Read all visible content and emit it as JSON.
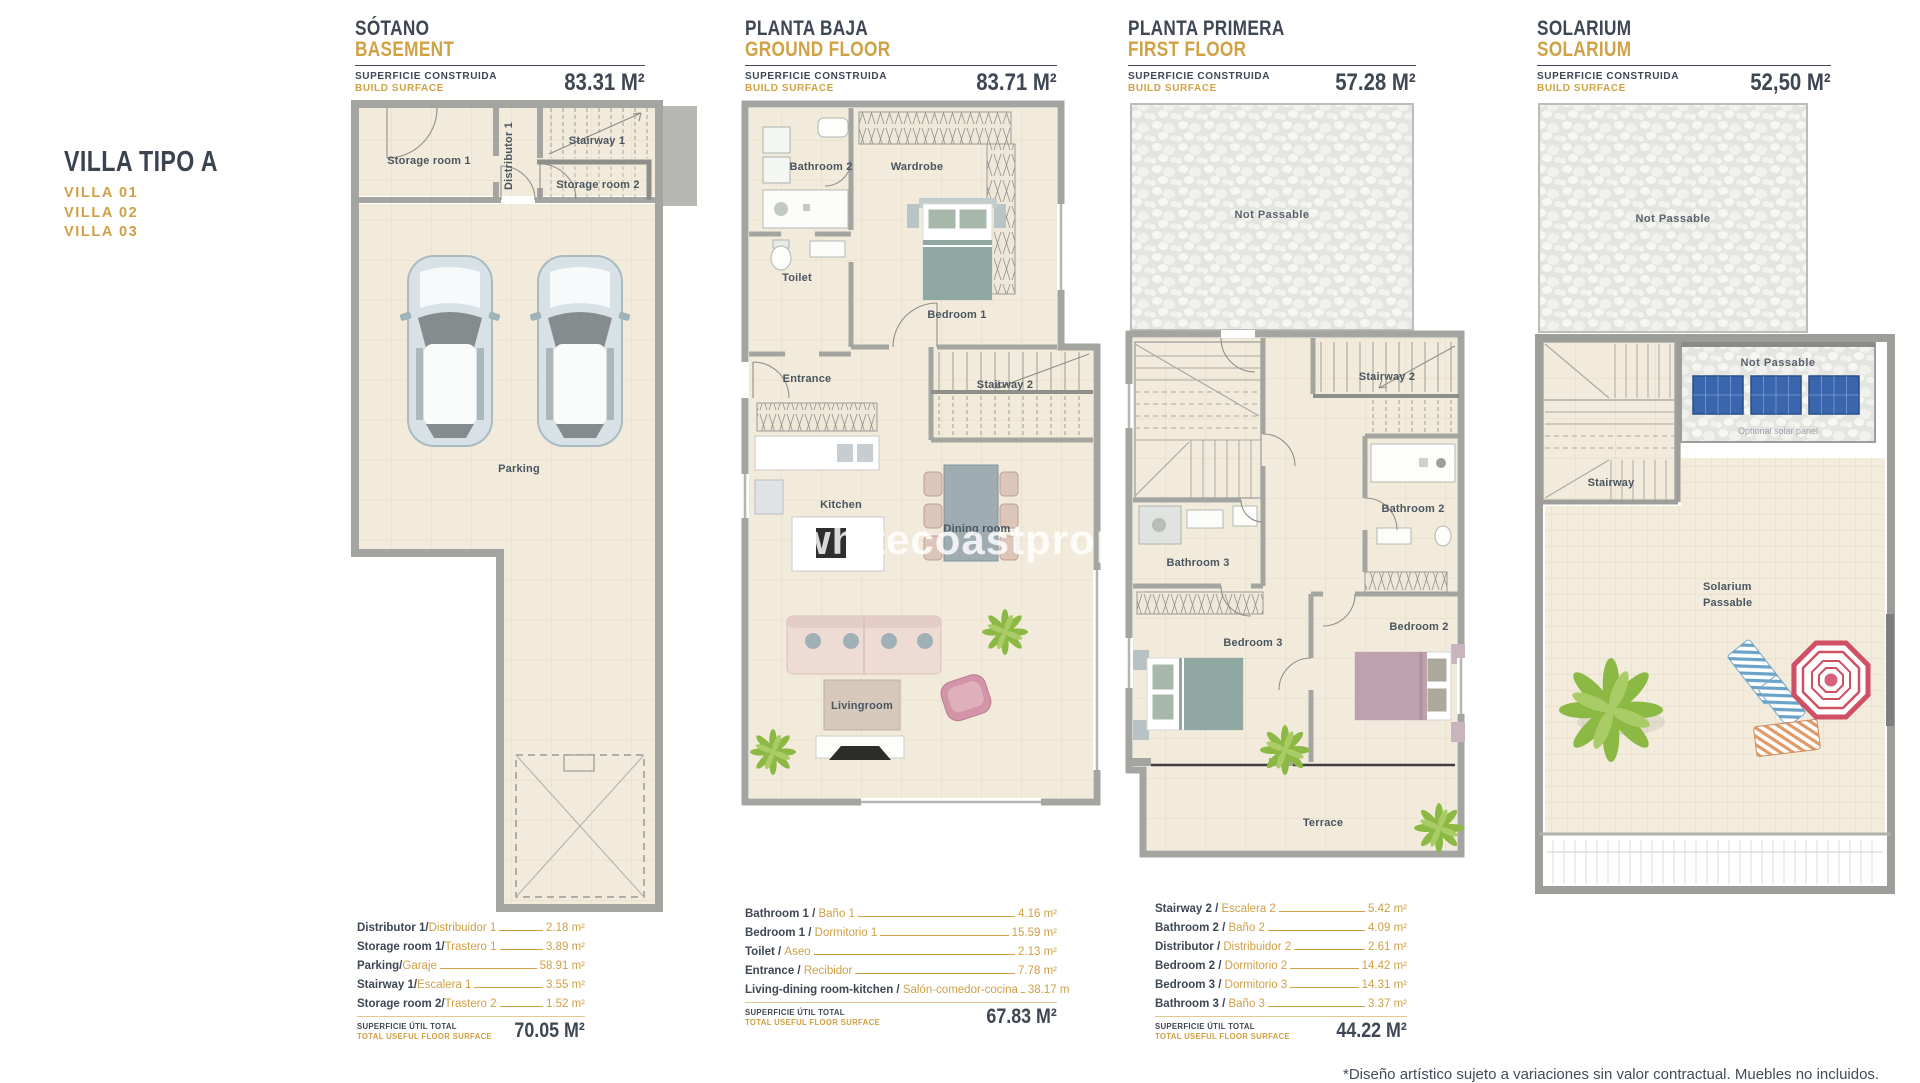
{
  "sidebar": {
    "title": "VILLA TIPO A",
    "villas": [
      "VILLA 01",
      "VILLA 02",
      "VILLA 03"
    ]
  },
  "labels": {
    "surface_es": "SUPERFICIE CONSTRUIDA",
    "surface_en": "BUILD SURFACE",
    "total_es": "SUPERFICIE ÚTIL TOTAL",
    "total_en": "TOTAL USEFUL FLOOR SURFACE"
  },
  "watermark": "whitecoastproperties",
  "disclaimer": "*Diseño artístico sujeto a variaciones sin valor contractual. Muebles no incluidos.",
  "colors": {
    "accent": "#cfa045",
    "ink": "#3e4753",
    "wall": "#a4a4a1",
    "floor": "#f2ebdb",
    "bed_teal": "#8fa9a2",
    "bed_mauve": "#bfa1ad",
    "solar_panel": "#3a66ad",
    "umbrella": "#cf4f63",
    "plant": "#8cb944"
  },
  "plans": [
    {
      "id": "basement",
      "title_es": "SÓTANO",
      "title_en": "BASEMENT",
      "area": "83.31 M²",
      "rooms": {
        "storage1": "Storage room 1",
        "distributor": "Distributor 1",
        "stairway1": "Stairway 1",
        "storage2": "Storage room 2",
        "parking": "Parking"
      },
      "legend": [
        {
          "en": "Distributor 1/",
          "es": "Distribuidor 1",
          "value": "2.18 m²"
        },
        {
          "en": "Storage room 1/",
          "es": "Trastero 1",
          "value": "3.89 m²"
        },
        {
          "en": "Parking/",
          "es": "Garaje",
          "value": "58.91 m²"
        },
        {
          "en": "Stairway 1/",
          "es": "Escalera 1",
          "value": "3.55 m²"
        },
        {
          "en": "Storage room 2/",
          "es": "Trastero 2",
          "value": "1.52 m²"
        }
      ],
      "total": "70.05 M²"
    },
    {
      "id": "ground-floor",
      "title_es": "PLANTA BAJA",
      "title_en": "GROUND FLOOR",
      "area": "83.71 M²",
      "rooms": {
        "bathroom2": "Bathroom 2",
        "wardrobe": "Wardrobe",
        "toilet": "Toilet",
        "bedroom1": "Bedroom 1",
        "entrance": "Entrance",
        "stairway2": "Stairway 2",
        "kitchen": "Kitchen",
        "dining": "Dining room",
        "living": "Livingroom"
      },
      "legend": [
        {
          "en": "Bathroom 1 / ",
          "es": "Baño 1",
          "value": "4.16 m²"
        },
        {
          "en": "Bedroom 1 / ",
          "es": "Dormitorio 1",
          "value": "15.59 m²"
        },
        {
          "en": "Toilet / ",
          "es": "Aseo",
          "value": "2.13 m²"
        },
        {
          "en": "Entrance / ",
          "es": "Recibidor",
          "value": "7.78 m²"
        },
        {
          "en": "Living-dining room-kitchen / ",
          "es": "Salón-comedor-cocina",
          "value": "38.17 m"
        }
      ],
      "total": "67.83 M²"
    },
    {
      "id": "first-floor",
      "title_es": "PLANTA PRIMERA",
      "title_en": "FIRST FLOOR",
      "area": "57.28 M²",
      "rooms": {
        "not_passable": "Not Passable",
        "stairway2": "Stairway 2",
        "bathroom2": "Bathroom 2",
        "bathroom3": "Bathroom 3",
        "bedroom3": "Bedroom 3",
        "bedroom2": "Bedroom 2",
        "terrace": "Terrace"
      },
      "legend": [
        {
          "en": "Stairway 2 / ",
          "es": "Escalera 2",
          "value": "5.42 m²"
        },
        {
          "en": "Bathroom 2 / ",
          "es": "Baño 2",
          "value": "4.09 m²"
        },
        {
          "en": "Distributor / ",
          "es": "Distribuidor 2",
          "value": "2.61 m²"
        },
        {
          "en": "Bedroom 2 / ",
          "es": "Dormitorio 2",
          "value": "14.42 m²"
        },
        {
          "en": "Bedroom 3 / ",
          "es": "Dormitorio 3",
          "value": "14.31 m²"
        },
        {
          "en": "Bathroom 3 / ",
          "es": "Baño 3",
          "value": "3.37 m²"
        }
      ],
      "total": "44.22 M²"
    },
    {
      "id": "solarium",
      "title_es": "SOLARIUM",
      "title_en": "SOLARIUM",
      "area": "52,50 M²",
      "rooms": {
        "not_passable_top": "Not Passable",
        "not_passable_panels": "Not Passable",
        "optional_panel": "Optional solar panel",
        "stairway": "Stairway",
        "solarium_1": "Solarium",
        "solarium_2": "Passable"
      }
    }
  ]
}
